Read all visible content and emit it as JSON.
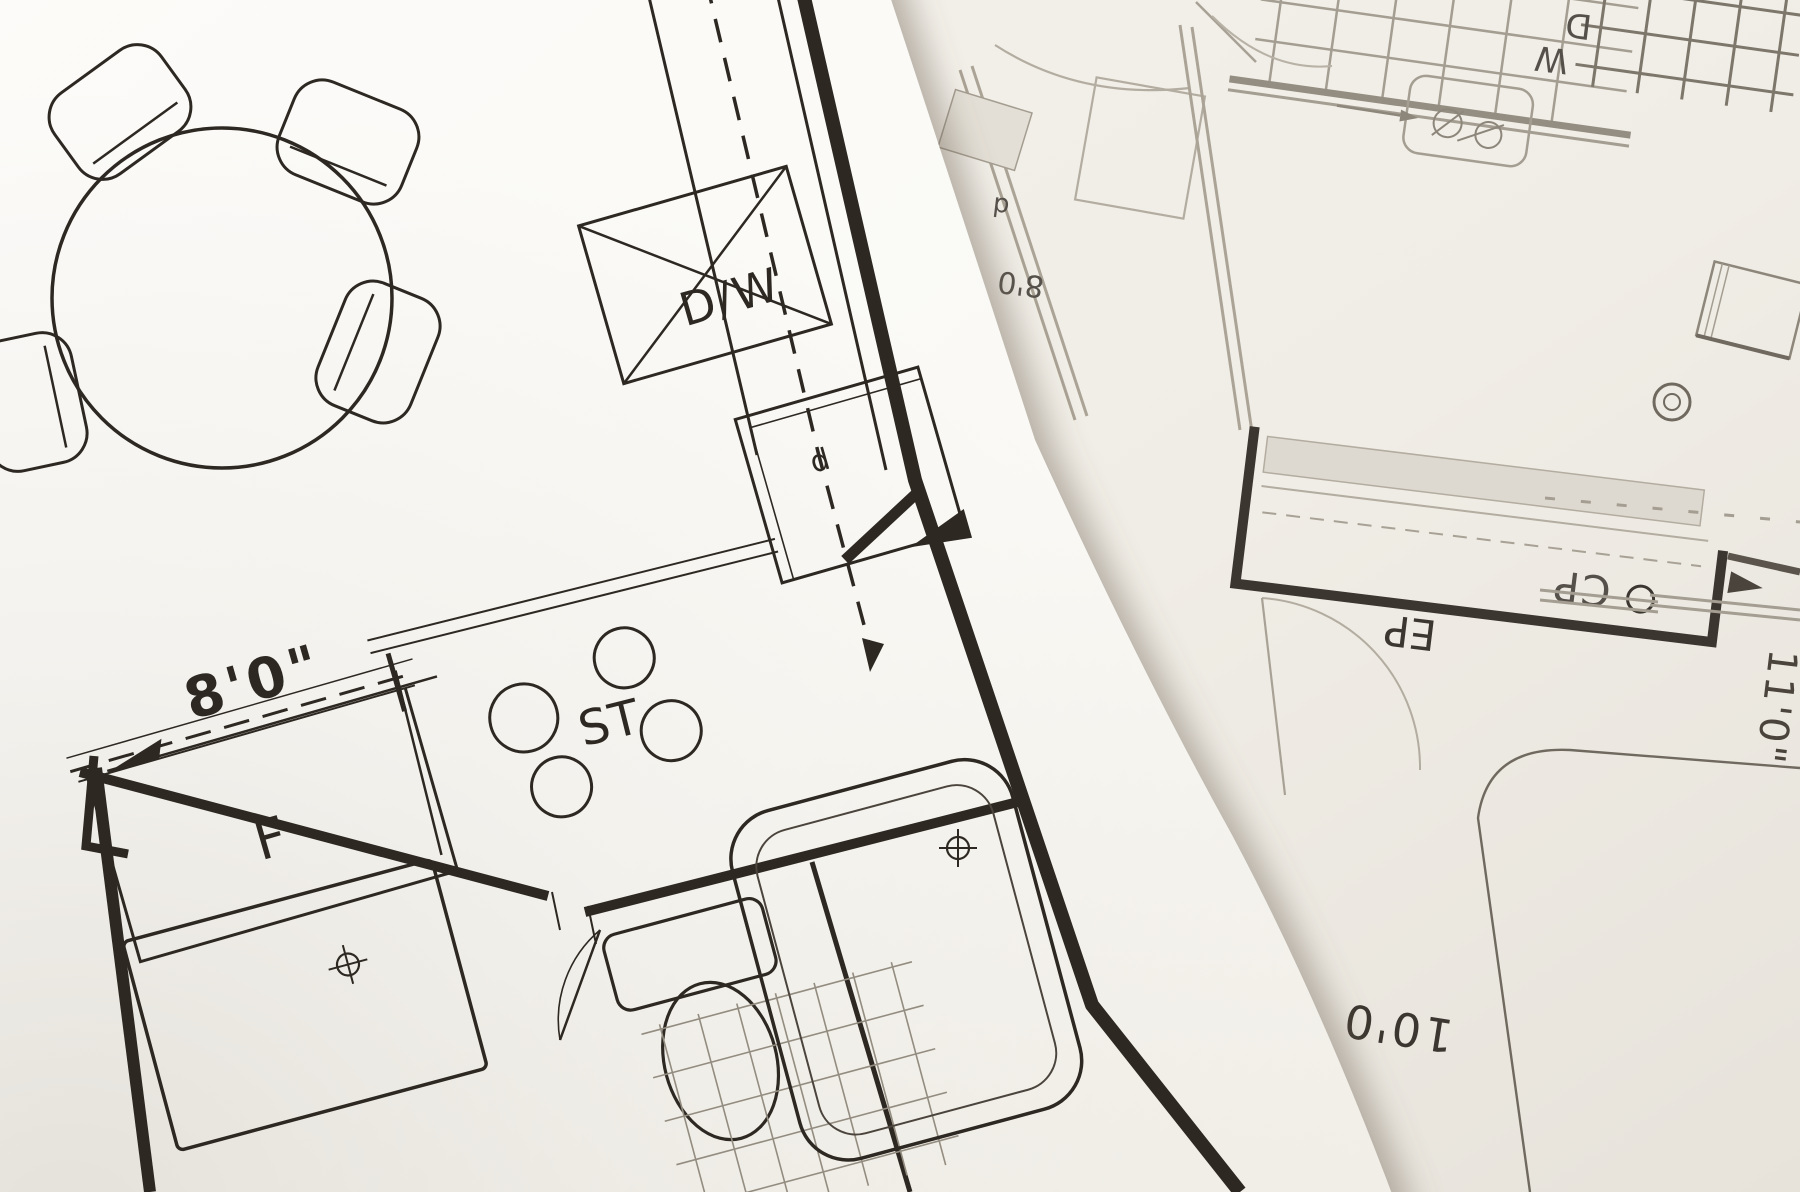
{
  "scene": {
    "description": "Photograph of two overlapping architectural floor-plan blueprint sheets",
    "sheets": [
      "foreground kitchen-bath plan (bold ink, tilted)",
      "background plan (faint ink, upside down)"
    ]
  },
  "colors": {
    "paper_left": "#fbfaf7",
    "paper_left_shade": "#efece5",
    "paper_right": "#f1eee8",
    "paper_right_shade": "#e7e3db",
    "ink_dark": "#2d2822",
    "ink_medium": "#8d867b",
    "ink_faint": "#b3aca0",
    "ink_back_dark": "#3b362f",
    "shelf_fill": "#ded9d0",
    "edge_shadow": "rgba(110,100,85,0.5)"
  },
  "left_plan": {
    "labels": {
      "dishwasher": "D/W",
      "stove": "ST",
      "refrigerator": "F",
      "sink_cabinet": "d"
    },
    "dimensions": {
      "kitchen_width": "8'0\""
    },
    "fixtures": [
      "round dining table",
      "four chairs",
      "kitchen counter with dashed centerline",
      "dishwasher with X",
      "sink cabinet",
      "stove with four burners",
      "refrigerator",
      "bathroom vanity",
      "toilet",
      "bathtub",
      "tiled floor"
    ]
  },
  "right_plan": {
    "orientation": "upside-down",
    "labels": {
      "closet": "CP",
      "electrical_panel": "EP",
      "washer": "W",
      "dryer": "D",
      "small_door": "d"
    },
    "dimensions": {
      "wall_right": "11'0\"",
      "room_width": "10'0",
      "edge_partial": "8'0"
    },
    "fixtures": [
      "deck grid",
      "closet with shelf and rod",
      "laundry tub",
      "door swing arcs",
      "large rounded room outline",
      "ceiling-light symbol"
    ]
  }
}
